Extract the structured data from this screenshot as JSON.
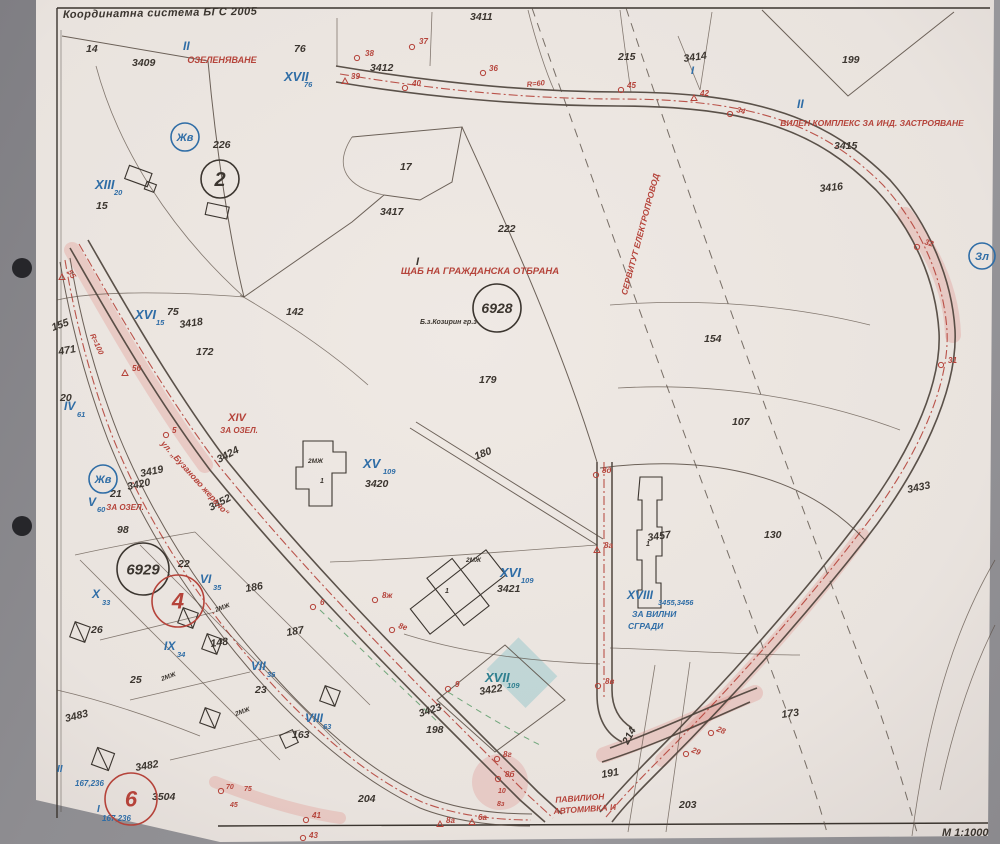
{
  "map": {
    "header": {
      "coordinate_system": "Координатна система БГС 2005",
      "scale": "М 1:1000"
    },
    "colors": {
      "k": "#3b352f",
      "r": "#b5433a",
      "b": "#2f6da6",
      "t": "#2e7f8f"
    },
    "labels": [
      {
        "t": "14",
        "x": 86,
        "y": 52
      },
      {
        "t": "3409",
        "x": 132,
        "y": 66
      },
      {
        "t": "76",
        "x": 294,
        "y": 52
      },
      {
        "t": "3411",
        "x": 470,
        "y": 20
      },
      {
        "t": "3412",
        "x": 370,
        "y": 71
      },
      {
        "t": "215",
        "x": 618,
        "y": 60
      },
      {
        "t": "3414",
        "x": 684,
        "y": 62,
        "rot": -8
      },
      {
        "t": "199",
        "x": 842,
        "y": 63
      },
      {
        "t": "3415",
        "x": 834,
        "y": 149
      },
      {
        "t": "3416",
        "x": 820,
        "y": 192,
        "rot": -6
      },
      {
        "t": "226",
        "x": 213,
        "y": 148
      },
      {
        "t": "17",
        "x": 400,
        "y": 170
      },
      {
        "t": "3417",
        "x": 380,
        "y": 215
      },
      {
        "t": "222",
        "x": 498,
        "y": 232
      },
      {
        "t": "15",
        "x": 96,
        "y": 209
      },
      {
        "t": "75",
        "x": 167,
        "y": 315
      },
      {
        "t": "3418",
        "x": 180,
        "y": 328,
        "rot": -8
      },
      {
        "t": "172",
        "x": 196,
        "y": 355
      },
      {
        "t": "142",
        "x": 286,
        "y": 315
      },
      {
        "t": "179",
        "x": 479,
        "y": 383
      },
      {
        "t": "154",
        "x": 704,
        "y": 342
      },
      {
        "t": "107",
        "x": 732,
        "y": 425
      },
      {
        "t": "3433",
        "x": 908,
        "y": 493,
        "rot": -12
      },
      {
        "t": "130",
        "x": 764,
        "y": 538
      },
      {
        "t": "155",
        "x": 53,
        "y": 331,
        "rot": -20
      },
      {
        "t": "471",
        "x": 59,
        "y": 355,
        "rot": -10
      },
      {
        "t": "20",
        "x": 60,
        "y": 401
      },
      {
        "t": "21",
        "x": 110,
        "y": 497
      },
      {
        "t": "98",
        "x": 117,
        "y": 533
      },
      {
        "t": "3424",
        "x": 219,
        "y": 463,
        "rot": -28
      },
      {
        "t": "3419",
        "x": 141,
        "y": 477,
        "rot": -12
      },
      {
        "t": "3420",
        "x": 128,
        "y": 490,
        "rot": -12
      },
      {
        "t": "3452",
        "x": 211,
        "y": 511,
        "rot": -28
      },
      {
        "t": "180",
        "x": 476,
        "y": 460,
        "rot": -22
      },
      {
        "t": "22",
        "x": 178,
        "y": 567
      },
      {
        "t": "186",
        "x": 246,
        "y": 592,
        "rot": -10
      },
      {
        "t": "26",
        "x": 91,
        "y": 633
      },
      {
        "t": "148",
        "x": 211,
        "y": 647,
        "rot": -8
      },
      {
        "t": "187",
        "x": 287,
        "y": 636,
        "rot": -10
      },
      {
        "t": "25",
        "x": 130,
        "y": 683
      },
      {
        "t": "23",
        "x": 255,
        "y": 693
      },
      {
        "t": "3483",
        "x": 66,
        "y": 722,
        "rot": -14
      },
      {
        "t": "3482",
        "x": 136,
        "y": 771,
        "rot": -10
      },
      {
        "t": "3504",
        "x": 152,
        "y": 800
      },
      {
        "t": "163",
        "x": 292,
        "y": 738
      },
      {
        "t": "198",
        "x": 426,
        "y": 733
      },
      {
        "t": "204",
        "x": 358,
        "y": 802
      },
      {
        "t": "214",
        "x": 628,
        "y": 745,
        "rot": -62
      },
      {
        "t": "191",
        "x": 602,
        "y": 778,
        "rot": -10
      },
      {
        "t": "173",
        "x": 782,
        "y": 718,
        "rot": -8
      },
      {
        "t": "203",
        "x": 679,
        "y": 808
      },
      {
        "t": "3420",
        "x": 365,
        "y": 487
      },
      {
        "t": "3421",
        "x": 497,
        "y": 592
      },
      {
        "t": "3422",
        "x": 480,
        "y": 695,
        "rot": -10
      },
      {
        "t": "3423",
        "x": 420,
        "y": 717,
        "rot": -18
      },
      {
        "t": "3457",
        "x": 648,
        "y": 541,
        "rot": -8
      },
      {
        "t": "Б.з.Козирин гр.з",
        "x": 420,
        "y": 324,
        "fs": 7
      },
      {
        "t": "2МЖ",
        "x": 308,
        "y": 463,
        "fs": 6.5
      },
      {
        "t": "1",
        "x": 320,
        "y": 483,
        "fs": 7
      },
      {
        "t": "2МЖ",
        "x": 466,
        "y": 562,
        "fs": 6.5
      },
      {
        "t": "1",
        "x": 445,
        "y": 593,
        "fs": 7
      },
      {
        "t": "1",
        "x": 646,
        "y": 546,
        "fs": 7
      },
      {
        "t": "2МЖ",
        "x": 216,
        "y": 612,
        "fs": 6.5,
        "rot": -20
      },
      {
        "t": "2МЖ",
        "x": 162,
        "y": 681,
        "fs": 6.5,
        "rot": -20
      },
      {
        "t": "2МЖ",
        "x": 236,
        "y": 716,
        "fs": 6.5,
        "rot": -20
      },
      {
        "t": "II",
        "x": 183,
        "y": 50,
        "c": "b",
        "fs": 12
      },
      {
        "t": "XVII",
        "x": 284,
        "y": 81,
        "c": "b",
        "fs": 13
      },
      {
        "t": "76",
        "x": 304,
        "y": 87,
        "c": "b",
        "fs": 7.5
      },
      {
        "t": "XIII",
        "x": 95,
        "y": 189,
        "c": "b",
        "fs": 13
      },
      {
        "t": "20",
        "x": 114,
        "y": 195,
        "c": "b",
        "fs": 7.5
      },
      {
        "t": "XVI",
        "x": 135,
        "y": 319,
        "c": "b",
        "fs": 13
      },
      {
        "t": "15",
        "x": 156,
        "y": 325,
        "c": "b",
        "fs": 7.5
      },
      {
        "t": "IV",
        "x": 64,
        "y": 410,
        "c": "b",
        "fs": 12
      },
      {
        "t": "61",
        "x": 77,
        "y": 417,
        "c": "b",
        "fs": 7.5
      },
      {
        "t": "V",
        "x": 88,
        "y": 506,
        "c": "b",
        "fs": 12
      },
      {
        "t": "60",
        "x": 97,
        "y": 512,
        "c": "b",
        "fs": 7.5
      },
      {
        "t": "VI",
        "x": 200,
        "y": 583,
        "c": "b",
        "fs": 12
      },
      {
        "t": "35",
        "x": 213,
        "y": 590,
        "c": "b",
        "fs": 7.5
      },
      {
        "t": "X",
        "x": 92,
        "y": 598,
        "c": "b",
        "fs": 12
      },
      {
        "t": "33",
        "x": 102,
        "y": 605,
        "c": "b",
        "fs": 7.5
      },
      {
        "t": "IX",
        "x": 164,
        "y": 650,
        "c": "b",
        "fs": 12
      },
      {
        "t": "34",
        "x": 177,
        "y": 657,
        "c": "b",
        "fs": 7.5
      },
      {
        "t": "VII",
        "x": 251,
        "y": 670,
        "c": "b",
        "fs": 12
      },
      {
        "t": "36",
        "x": 267,
        "y": 677,
        "c": "b",
        "fs": 7.5
      },
      {
        "t": "VIII",
        "x": 305,
        "y": 722,
        "c": "b",
        "fs": 12
      },
      {
        "t": "63",
        "x": 323,
        "y": 729,
        "c": "b",
        "fs": 7.5
      },
      {
        "t": "II",
        "x": 797,
        "y": 108,
        "c": "b",
        "fs": 12
      },
      {
        "t": "I",
        "x": 691,
        "y": 74,
        "c": "b",
        "fs": 11
      },
      {
        "t": "I",
        "x": 416,
        "y": 265,
        "fs": 11
      },
      {
        "t": "XV",
        "x": 363,
        "y": 468,
        "c": "b",
        "fs": 13
      },
      {
        "t": "109",
        "x": 383,
        "y": 474,
        "c": "b",
        "fs": 7.5
      },
      {
        "t": "XVI",
        "x": 500,
        "y": 577,
        "c": "b",
        "fs": 13
      },
      {
        "t": "109",
        "x": 521,
        "y": 583,
        "c": "b",
        "fs": 7.5
      },
      {
        "t": "XVII",
        "x": 485,
        "y": 682,
        "c": "t",
        "fs": 13
      },
      {
        "t": "109",
        "x": 507,
        "y": 688,
        "c": "t",
        "fs": 7.5
      },
      {
        "t": "XVIII",
        "x": 627,
        "y": 599,
        "c": "b",
        "fs": 12
      },
      {
        "t": "3455,3456",
        "x": 658,
        "y": 605,
        "c": "b",
        "fs": 7.5
      },
      {
        "t": "ЗА ВИЛНИ",
        "x": 632,
        "y": 617,
        "c": "b",
        "fs": 8.5
      },
      {
        "t": "СГРАДИ",
        "x": 628,
        "y": 629,
        "c": "b",
        "fs": 8.5
      },
      {
        "t": "167,236",
        "x": 75,
        "y": 786,
        "c": "b",
        "fs": 8
      },
      {
        "t": "167,236",
        "x": 102,
        "y": 821,
        "c": "b",
        "fs": 8
      },
      {
        "t": "II",
        "x": 57,
        "y": 772,
        "c": "b",
        "fs": 10
      },
      {
        "t": "I",
        "x": 97,
        "y": 812,
        "c": "b",
        "fs": 10
      },
      {
        "t": "ОЗЕЛЕНЯВАНЕ",
        "x": 222,
        "y": 63,
        "c": "r",
        "fs": 9,
        "a": "m"
      },
      {
        "t": "ВИЛЕН КОМПЛЕКС ЗА ИНД. ЗАСТРОЯВАНЕ",
        "x": 872,
        "y": 126,
        "c": "r",
        "fs": 8.5,
        "a": "m"
      },
      {
        "t": "ЩАБ НА ГРАЖДАНСКА ОТБРАНА",
        "x": 480,
        "y": 274,
        "c": "r",
        "fs": 9.5,
        "a": "m"
      },
      {
        "t": "СЕРВИТУТ ЕЛЕКТРОПРОВОД",
        "x": 643,
        "y": 235,
        "c": "r",
        "fs": 8.5,
        "a": "m",
        "rot": -75
      },
      {
        "t": "XIV",
        "x": 237,
        "y": 421,
        "c": "r",
        "fs": 11,
        "a": "m"
      },
      {
        "t": "ЗА ОЗЕЛ.",
        "x": 239,
        "y": 433,
        "c": "r",
        "fs": 8,
        "a": "m"
      },
      {
        "t": "ЗА ОЗЕЛ.",
        "x": 125,
        "y": 510,
        "c": "r",
        "fs": 8,
        "a": "m"
      },
      {
        "t": "ул. „Бузаново жерело“",
        "x": 193,
        "y": 480,
        "c": "r",
        "fs": 8.5,
        "a": "m",
        "rot": 48
      },
      {
        "t": "ПАВИЛИОН",
        "x": 580,
        "y": 801,
        "c": "r",
        "fs": 8.5,
        "a": "m",
        "rot": -4
      },
      {
        "t": "АВТОМИВКА И",
        "x": 585,
        "y": 812,
        "c": "r",
        "fs": 8.5,
        "a": "m",
        "rot": -4
      },
      {
        "t": "R=60",
        "x": 527,
        "y": 87,
        "c": "r",
        "fs": 7.5,
        "rot": -6
      },
      {
        "t": "R=100",
        "x": 90,
        "y": 335,
        "c": "r",
        "fs": 7.5,
        "rot": 65
      },
      {
        "t": "38",
        "x": 365,
        "y": 56,
        "c": "r",
        "fs": 8
      },
      {
        "t": "37",
        "x": 419,
        "y": 44,
        "c": "r",
        "fs": 8
      },
      {
        "t": "39",
        "x": 351,
        "y": 79,
        "c": "r",
        "fs": 8
      },
      {
        "t": "40",
        "x": 412,
        "y": 86,
        "c": "r",
        "fs": 8
      },
      {
        "t": "36",
        "x": 489,
        "y": 71,
        "c": "r",
        "fs": 8
      },
      {
        "t": "45",
        "x": 627,
        "y": 88,
        "c": "r",
        "fs": 8
      },
      {
        "t": "42",
        "x": 700,
        "y": 96,
        "c": "r",
        "fs": 8
      },
      {
        "t": "34",
        "x": 736,
        "y": 112,
        "c": "r",
        "fs": 8,
        "rot": 15
      },
      {
        "t": "32",
        "x": 924,
        "y": 244,
        "c": "r",
        "fs": 8,
        "rot": 18
      },
      {
        "t": "31",
        "x": 948,
        "y": 363,
        "c": "r",
        "fs": 8
      },
      {
        "t": "55",
        "x": 67,
        "y": 272,
        "c": "r",
        "fs": 8,
        "rot": 55
      },
      {
        "t": "56",
        "x": 132,
        "y": 371,
        "c": "r",
        "fs": 8
      },
      {
        "t": "5",
        "x": 172,
        "y": 433,
        "c": "r",
        "fs": 8
      },
      {
        "t": "6",
        "x": 320,
        "y": 605,
        "c": "r",
        "fs": 8
      },
      {
        "t": "8ж",
        "x": 382,
        "y": 598,
        "c": "r",
        "fs": 8
      },
      {
        "t": "8е",
        "x": 398,
        "y": 628,
        "c": "r",
        "fs": 8,
        "rot": 15
      },
      {
        "t": "8д",
        "x": 602,
        "y": 473,
        "c": "r",
        "fs": 8
      },
      {
        "t": "8а",
        "x": 604,
        "y": 548,
        "c": "r",
        "fs": 8
      },
      {
        "t": "8в",
        "x": 605,
        "y": 684,
        "c": "r",
        "fs": 8
      },
      {
        "t": "9",
        "x": 455,
        "y": 687,
        "c": "r",
        "fs": 8
      },
      {
        "t": "8г",
        "x": 503,
        "y": 757,
        "c": "r",
        "fs": 8
      },
      {
        "t": "8б",
        "x": 505,
        "y": 777,
        "c": "r",
        "fs": 8
      },
      {
        "t": "10",
        "x": 498,
        "y": 793,
        "c": "r",
        "fs": 7
      },
      {
        "t": "8з",
        "x": 497,
        "y": 806,
        "c": "r",
        "fs": 7
      },
      {
        "t": "8а",
        "x": 446,
        "y": 823,
        "c": "r",
        "fs": 8
      },
      {
        "t": "6а",
        "x": 478,
        "y": 820,
        "c": "r",
        "fs": 8
      },
      {
        "t": "41",
        "x": 312,
        "y": 818,
        "c": "r",
        "fs": 8
      },
      {
        "t": "43",
        "x": 309,
        "y": 838,
        "c": "r",
        "fs": 8
      },
      {
        "t": "70",
        "x": 226,
        "y": 789,
        "c": "r",
        "fs": 7
      },
      {
        "t": "75",
        "x": 244,
        "y": 791,
        "c": "r",
        "fs": 7
      },
      {
        "t": "45",
        "x": 230,
        "y": 807,
        "c": "r",
        "fs": 7
      },
      {
        "t": "29",
        "x": 691,
        "y": 752,
        "c": "r",
        "fs": 8,
        "rot": 22
      },
      {
        "t": "28",
        "x": 716,
        "y": 731,
        "c": "r",
        "fs": 8,
        "rot": 22
      }
    ],
    "circles": [
      {
        "t": "Жв",
        "x": 185,
        "y": 137,
        "r": 14,
        "c": "b",
        "fs": 11
      },
      {
        "t": "Жв",
        "x": 103,
        "y": 479,
        "r": 14,
        "c": "b",
        "fs": 11
      },
      {
        "t": "Зл",
        "x": 982,
        "y": 256,
        "r": 13,
        "c": "b",
        "fs": 11
      },
      {
        "t": "2",
        "x": 220,
        "y": 179,
        "r": 19,
        "c": "k",
        "fs": 20
      },
      {
        "t": "6928",
        "x": 497,
        "y": 308,
        "r": 24,
        "c": "k",
        "fs": 14
      },
      {
        "t": "6929",
        "x": 143,
        "y": 569,
        "r": 26,
        "c": "k",
        "fs": 15
      },
      {
        "t": "4",
        "x": 178,
        "y": 601,
        "r": 26,
        "c": "r",
        "fs": 22
      },
      {
        "t": "6",
        "x": 131,
        "y": 799,
        "r": 26,
        "c": "r",
        "fs": 22
      }
    ],
    "markers": [
      {
        "s": "c",
        "x": 357,
        "y": 58
      },
      {
        "s": "c",
        "x": 412,
        "y": 47
      },
      {
        "s": "t",
        "x": 345,
        "y": 81
      },
      {
        "s": "c",
        "x": 405,
        "y": 88
      },
      {
        "s": "c",
        "x": 483,
        "y": 73
      },
      {
        "s": "c",
        "x": 621,
        "y": 90
      },
      {
        "s": "t",
        "x": 694,
        "y": 98
      },
      {
        "s": "c",
        "x": 730,
        "y": 114
      },
      {
        "s": "c",
        "x": 917,
        "y": 247
      },
      {
        "s": "c",
        "x": 941,
        "y": 365
      },
      {
        "s": "t",
        "x": 62,
        "y": 277
      },
      {
        "s": "t",
        "x": 125,
        "y": 373
      },
      {
        "s": "c",
        "x": 166,
        "y": 435
      },
      {
        "s": "c",
        "x": 313,
        "y": 607
      },
      {
        "s": "c",
        "x": 375,
        "y": 600
      },
      {
        "s": "c",
        "x": 392,
        "y": 630
      },
      {
        "s": "c",
        "x": 596,
        "y": 475
      },
      {
        "s": "t",
        "x": 597,
        "y": 550
      },
      {
        "s": "c",
        "x": 598,
        "y": 686
      },
      {
        "s": "c",
        "x": 448,
        "y": 689
      },
      {
        "s": "c",
        "x": 497,
        "y": 759
      },
      {
        "s": "c",
        "x": 498,
        "y": 779
      },
      {
        "s": "t",
        "x": 440,
        "y": 824
      },
      {
        "s": "t",
        "x": 472,
        "y": 822
      },
      {
        "s": "c",
        "x": 306,
        "y": 820
      },
      {
        "s": "c",
        "x": 303,
        "y": 838
      },
      {
        "s": "c",
        "x": 686,
        "y": 754
      },
      {
        "s": "c",
        "x": 711,
        "y": 733
      },
      {
        "s": "c",
        "x": 221,
        "y": 791
      }
    ]
  }
}
